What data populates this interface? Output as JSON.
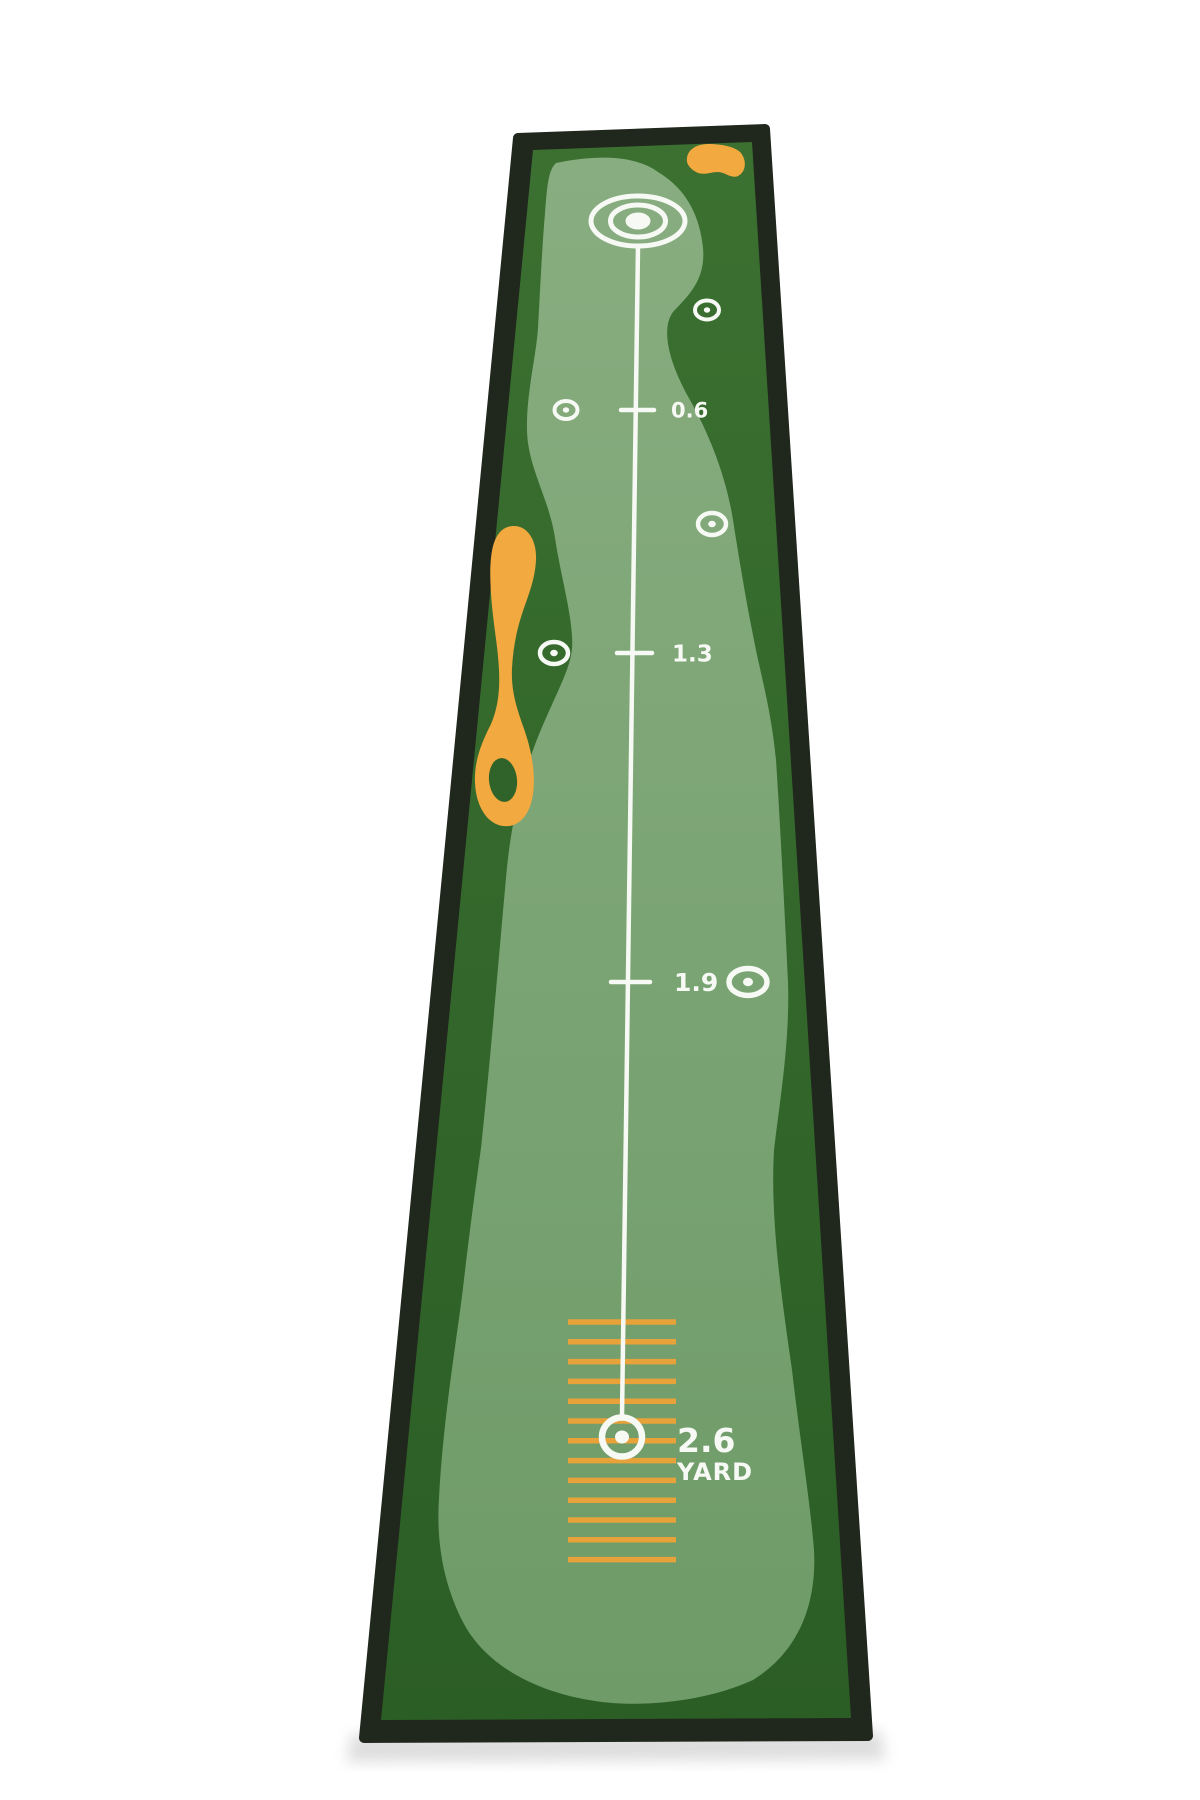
{
  "scene": {
    "description": "Overhead product photo of a long golf putting practice mat on a white background",
    "background_color": "#ffffff"
  },
  "colors": {
    "binding_black": "#20271c",
    "dark_green_top": "#3b7031",
    "dark_green_bottom": "#2b5e25",
    "lane_green_top": "#88ad80",
    "lane_green_bottom": "#6e9b68",
    "hazard_orange": "#f2a93f",
    "hash_orange": "#e7a23a",
    "marking_white": "#f7f9f4",
    "shadow_gray": "#b5b5b5"
  },
  "mat": {
    "distance_rows": [
      {
        "label": "0.6",
        "y": 410,
        "tick_x1": 621,
        "tick_x2": 654,
        "label_x": 671,
        "font_size": 21
      },
      {
        "label": "1.3",
        "y": 653,
        "tick_x1": 617,
        "tick_x2": 652,
        "label_x": 672,
        "font_size": 23
      },
      {
        "label": "1.9",
        "y": 982,
        "tick_x1": 611,
        "tick_x2": 650,
        "label_x": 674,
        "font_size": 25
      }
    ],
    "final_distance": {
      "value": "2.6",
      "unit": "YARD"
    },
    "markers": [
      {
        "x": 707,
        "y": 310,
        "rx": 12,
        "ry": 9.5,
        "dot": 3.2,
        "stroke": 4
      },
      {
        "x": 566,
        "y": 410,
        "rx": 11.5,
        "ry": 9,
        "dot": 3.2,
        "stroke": 4
      },
      {
        "x": 712,
        "y": 524,
        "rx": 14,
        "ry": 11,
        "dot": 3.8,
        "stroke": 4.5
      },
      {
        "x": 554,
        "y": 653,
        "rx": 14,
        "ry": 11,
        "dot": 3.8,
        "stroke": 4.5
      },
      {
        "x": 748,
        "y": 982,
        "rx": 19,
        "ry": 13.5,
        "dot": 5,
        "stroke": 5.5
      }
    ],
    "hash_lines": {
      "count": 13,
      "x1": 568,
      "x2": 676,
      "y_start": 1322,
      "y_step": 19.8,
      "thickness": 5.5
    },
    "center_line": {
      "x1": 638,
      "y1": 246,
      "x2": 622,
      "y2": 1417,
      "thickness": 4.5
    },
    "start_target": {
      "cx": 638,
      "cy": 221,
      "outer_rx": 47,
      "outer_ry": 25,
      "mid_rx": 27.5,
      "mid_ry": 16,
      "core_rx": 12.5,
      "core_ry": 8.5,
      "stroke": 5
    },
    "end_target": {
      "cx": 622,
      "cy": 1437,
      "rx": 20,
      "ry": 19.5,
      "dot": 7,
      "stroke": 6.5
    }
  }
}
